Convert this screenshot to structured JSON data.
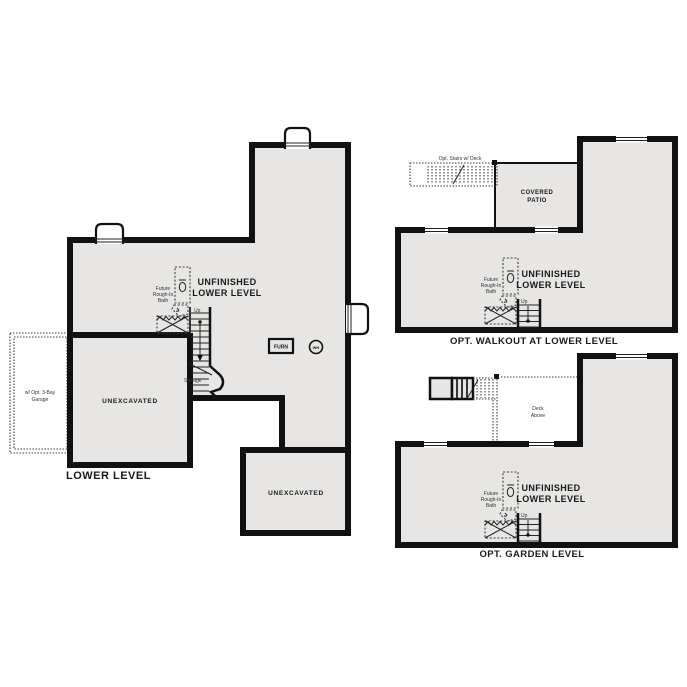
{
  "colors": {
    "background": "#ffffff",
    "floor_fill": "#e7e6e4",
    "wall": "#111111",
    "text": "#1a1a1a"
  },
  "lower_level": {
    "title": "LOWER LEVEL",
    "unfinished_line1": "UNFINISHED",
    "unfinished_line2": "LOWER LEVEL",
    "unexcavated_left": "UNEXCAVATED",
    "unexcavated_right": "UNEXCAVATED",
    "garage_opt_line1": "w/ Opt. 3-Bay",
    "garage_opt_line2": "Garage",
    "future_bath_line1": "Future",
    "future_bath_line2": "Rough-In",
    "future_bath_line3": "Bath",
    "up": "Up",
    "storage": "Storage",
    "furnace": "FURN",
    "water_heater": "WH"
  },
  "walkout": {
    "title": "OPT. WALKOUT AT LOWER LEVEL",
    "covered_patio_line1": "COVERED",
    "covered_patio_line2": "PATIO",
    "opt_stairs_deck": "Opt. Stairs w/ Deck",
    "unfinished_line1": "UNFINISHED",
    "unfinished_line2": "LOWER LEVEL",
    "future_bath_line1": "Future",
    "future_bath_line2": "Rough-In",
    "future_bath_line3": "Bath",
    "up": "Up"
  },
  "garden": {
    "title": "OPT. GARDEN LEVEL",
    "deck_above_line1": "Deck",
    "deck_above_line2": "Above",
    "unfinished_line1": "UNFINISHED",
    "unfinished_line2": "LOWER LEVEL",
    "future_bath_line1": "Future",
    "future_bath_line2": "Rough-In",
    "future_bath_line3": "Bath",
    "up": "Up"
  }
}
